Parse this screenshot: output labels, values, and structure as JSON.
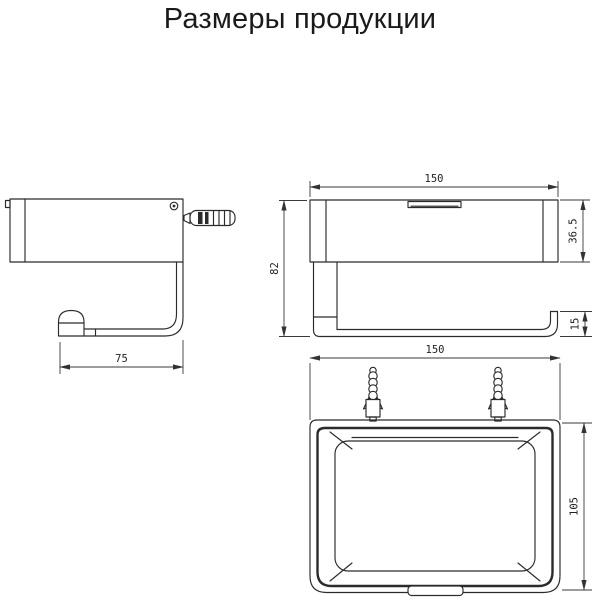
{
  "title": "Размеры продукции",
  "dims": {
    "side_width": "75",
    "front_width": "150",
    "front_box_height": "36.5",
    "front_total_height": "82",
    "front_bar_height": "15",
    "top_width": "150",
    "top_depth": "105"
  },
  "colors": {
    "background": "#ffffff",
    "object_line": "#2b2b2b",
    "dimension_line": "#3a3a3a",
    "title_text": "#1a1a1a"
  }
}
